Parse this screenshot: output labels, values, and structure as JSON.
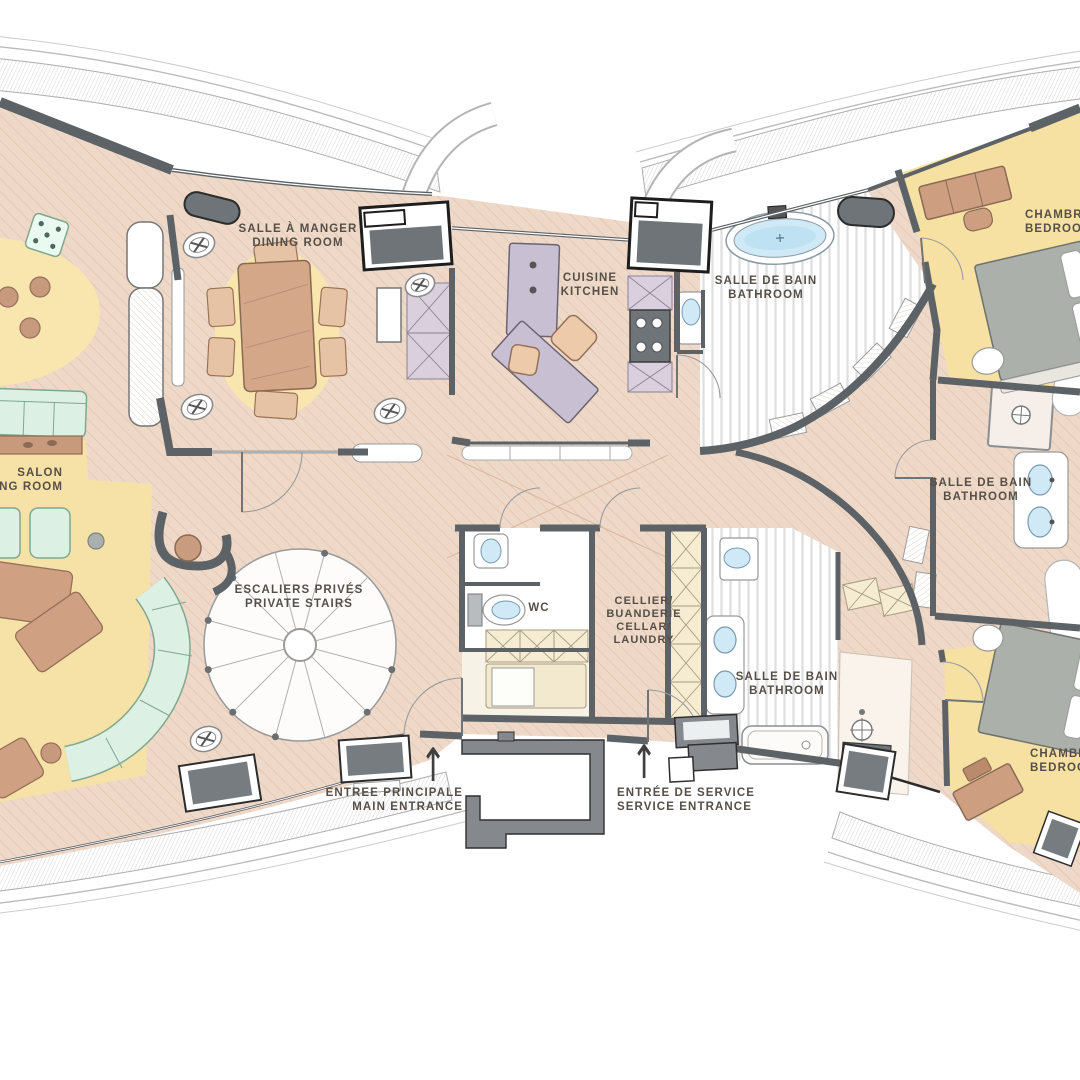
{
  "document": {
    "type": "apartment floor plan",
    "languages": "French / English"
  },
  "labels": {
    "dining": {
      "fr": "SALLE À MANGER",
      "en": "DINING ROOM"
    },
    "kitchen": {
      "fr": "CUISINE",
      "en": "KITCHEN"
    },
    "bathroom_master": {
      "fr": "SALLE DE BAIN",
      "en": "BATHROOM"
    },
    "bedroom_1": {
      "fr": "CHAMBRE",
      "en": "BEDROOM"
    },
    "living": {
      "fr": "SALON",
      "en": "LIVING ROOM"
    },
    "stairs": {
      "fr": "ESCALIERS PRIVÉS",
      "en": "PRIVATE STAIRS"
    },
    "wc": {
      "fr": "WC"
    },
    "cellar": {
      "fr_1": "CELLIER/",
      "fr_2": "BUANDERIE",
      "en_1": "CELLAR/",
      "en_2": "LAUNDRY"
    },
    "bathroom_2": {
      "fr": "SALLE DE BAIN",
      "en": "BATHROOM"
    },
    "bathroom_3": {
      "fr": "SALLE DE BAIN",
      "en": "BATHROOM"
    },
    "bedroom_2": {
      "fr": "CHAMBRE",
      "en": "BEDROOM"
    },
    "entrance_main": {
      "fr": "ENTREE PRINCIPALE",
      "en": "MAIN ENTRANCE"
    },
    "entrance_service": {
      "fr": "ENTRÉE DE SERVICE",
      "en": "SERVICE ENTRANCE"
    }
  },
  "icons": {
    "entrance_arrow": "↑"
  },
  "colors": {
    "floor": "#eed9c9",
    "floor_hatch": "#ddbda4",
    "rug_yellow": "#f8e6ae",
    "bedroom_yellow": "#f6e1a3",
    "sofa_mint": "#ddf0e4",
    "furniture_brown": "#d3a788",
    "wall_gray": "#5c6266",
    "water_blue": "#cfe9f6",
    "kitchen_island_purple": "#c9bfd2",
    "cabinet_cream": "#f5ecd2",
    "porch_gray": "#85898d",
    "bed_gray": "#abb0ab",
    "text": "#564f47"
  }
}
